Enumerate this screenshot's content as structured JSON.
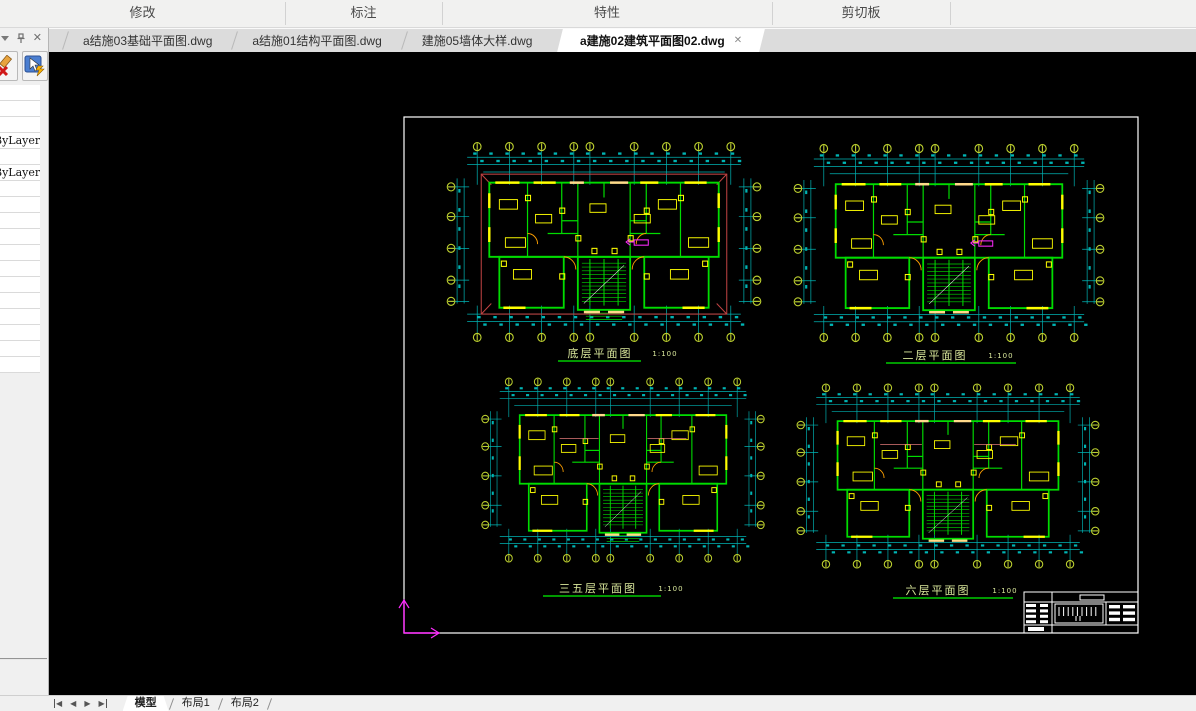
{
  "ribbon": {
    "groups": [
      {
        "label": "修改"
      },
      {
        "label": "标注"
      },
      {
        "label": "特性"
      },
      {
        "label": "剪切板"
      }
    ]
  },
  "doc_tabs": {
    "close_label": "✕",
    "tabs": [
      {
        "label": "a结施03基础平面图.dwg",
        "active": false
      },
      {
        "label": "a结施01结构平面图.dwg",
        "active": false
      },
      {
        "label": "建施05墙体大样.dwg",
        "active": false
      },
      {
        "label": "a建施02建筑平面图02.dwg",
        "active": true
      }
    ]
  },
  "left_panel": {
    "rows": [
      "",
      "",
      "",
      "ByLayer",
      "",
      "ByLayer",
      "",
      "",
      "",
      "",
      "",
      "",
      "",
      "",
      "",
      "",
      "",
      ""
    ]
  },
  "canvas": {
    "plans": [
      {
        "label": "底层平面图",
        "scale": "1:100"
      },
      {
        "label": "二层平面图",
        "scale": "1:100"
      },
      {
        "label": "三五层平面图",
        "scale": "1:100"
      },
      {
        "label": "六层平面图",
        "scale": "1:100"
      }
    ]
  },
  "layout_bar": {
    "tabs": [
      {
        "label": "模型",
        "active": true
      },
      {
        "label": "布局1",
        "active": false
      },
      {
        "label": "布局2",
        "active": false
      }
    ]
  },
  "colors": {
    "dim_cyan": "#00b4b4",
    "wall_green": "#00dc00",
    "accent_yellow": "#ffff00",
    "cream": "#ffd98a",
    "axis_olive": "#bccf2f",
    "door_orange": "#ffa000",
    "magenta": "#ff2bff",
    "roof_red": "#c24444",
    "pink": "#e07878",
    "frame_white": "#ffffff",
    "label_text": "#d9e79b",
    "underline_green": "#00cc00"
  }
}
